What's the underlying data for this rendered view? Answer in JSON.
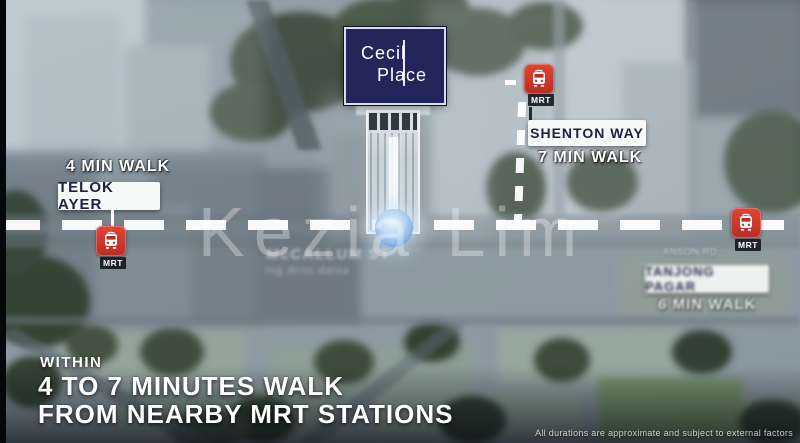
{
  "colors": {
    "mrt_red": "#d6392e",
    "logo_navy": "#23265a",
    "station_box_bg": "#f7f8f8",
    "station_text_dark": "#1d2240",
    "marker_blue": "#7fb3e8",
    "overlay_white": "#ffffff"
  },
  "logo": {
    "line1": "Cecil",
    "line2": "Place"
  },
  "stations": {
    "telok_ayer": {
      "walk_label": "4 MIN WALK",
      "name": "TELOK AYER",
      "mrt_badge": "MRT"
    },
    "shenton_way": {
      "name": "SHENTON WAY",
      "walk_label": "7 MIN WALK",
      "mrt_badge": "MRT"
    },
    "tanjong_pagar": {
      "street_label": "ANSON RD",
      "name": "TANJONG PAGAR",
      "walk_label": "6 MIN WALK",
      "mrt_badge": "MRT"
    }
  },
  "map_labels": {
    "street_blur_line1": "McCALLUM ST",
    "street_blur_line2": "ing dcnc dalsa"
  },
  "watermark": "Kezia Lim",
  "headline": {
    "line1": "WITHIN",
    "line2": "4 TO 7 MINUTES WALK",
    "line3": "FROM NEARBY MRT STATIONS"
  },
  "disclaimer": "All durations are approximate and subject to external factors"
}
